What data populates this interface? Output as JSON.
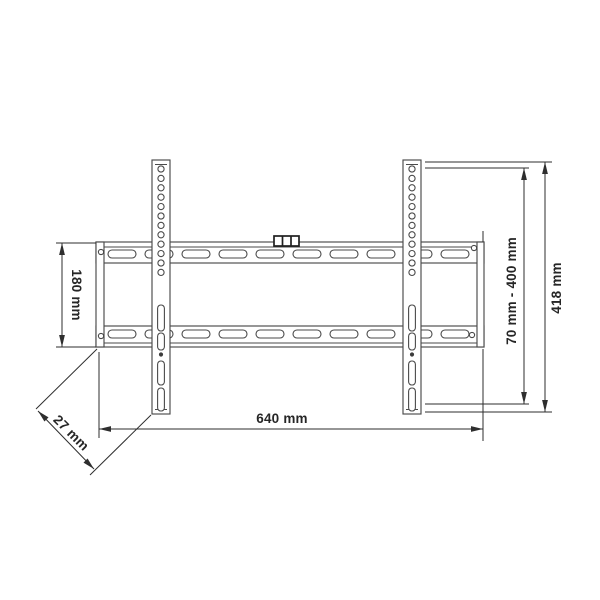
{
  "drawing": {
    "type": "technical-dimension-drawing",
    "subject": "fixed TV wall mount bracket, front view",
    "colors": {
      "background": "#ffffff",
      "part_line": "#4a4a4a",
      "dimension_line": "#2e2e2e",
      "label_text": "#262626"
    }
  },
  "labels": {
    "plate_height": "180 mm",
    "depth": "27 mm",
    "width": "640 mm",
    "mount_range": "70 mm - 400 mm",
    "total_height": "418 mm"
  }
}
